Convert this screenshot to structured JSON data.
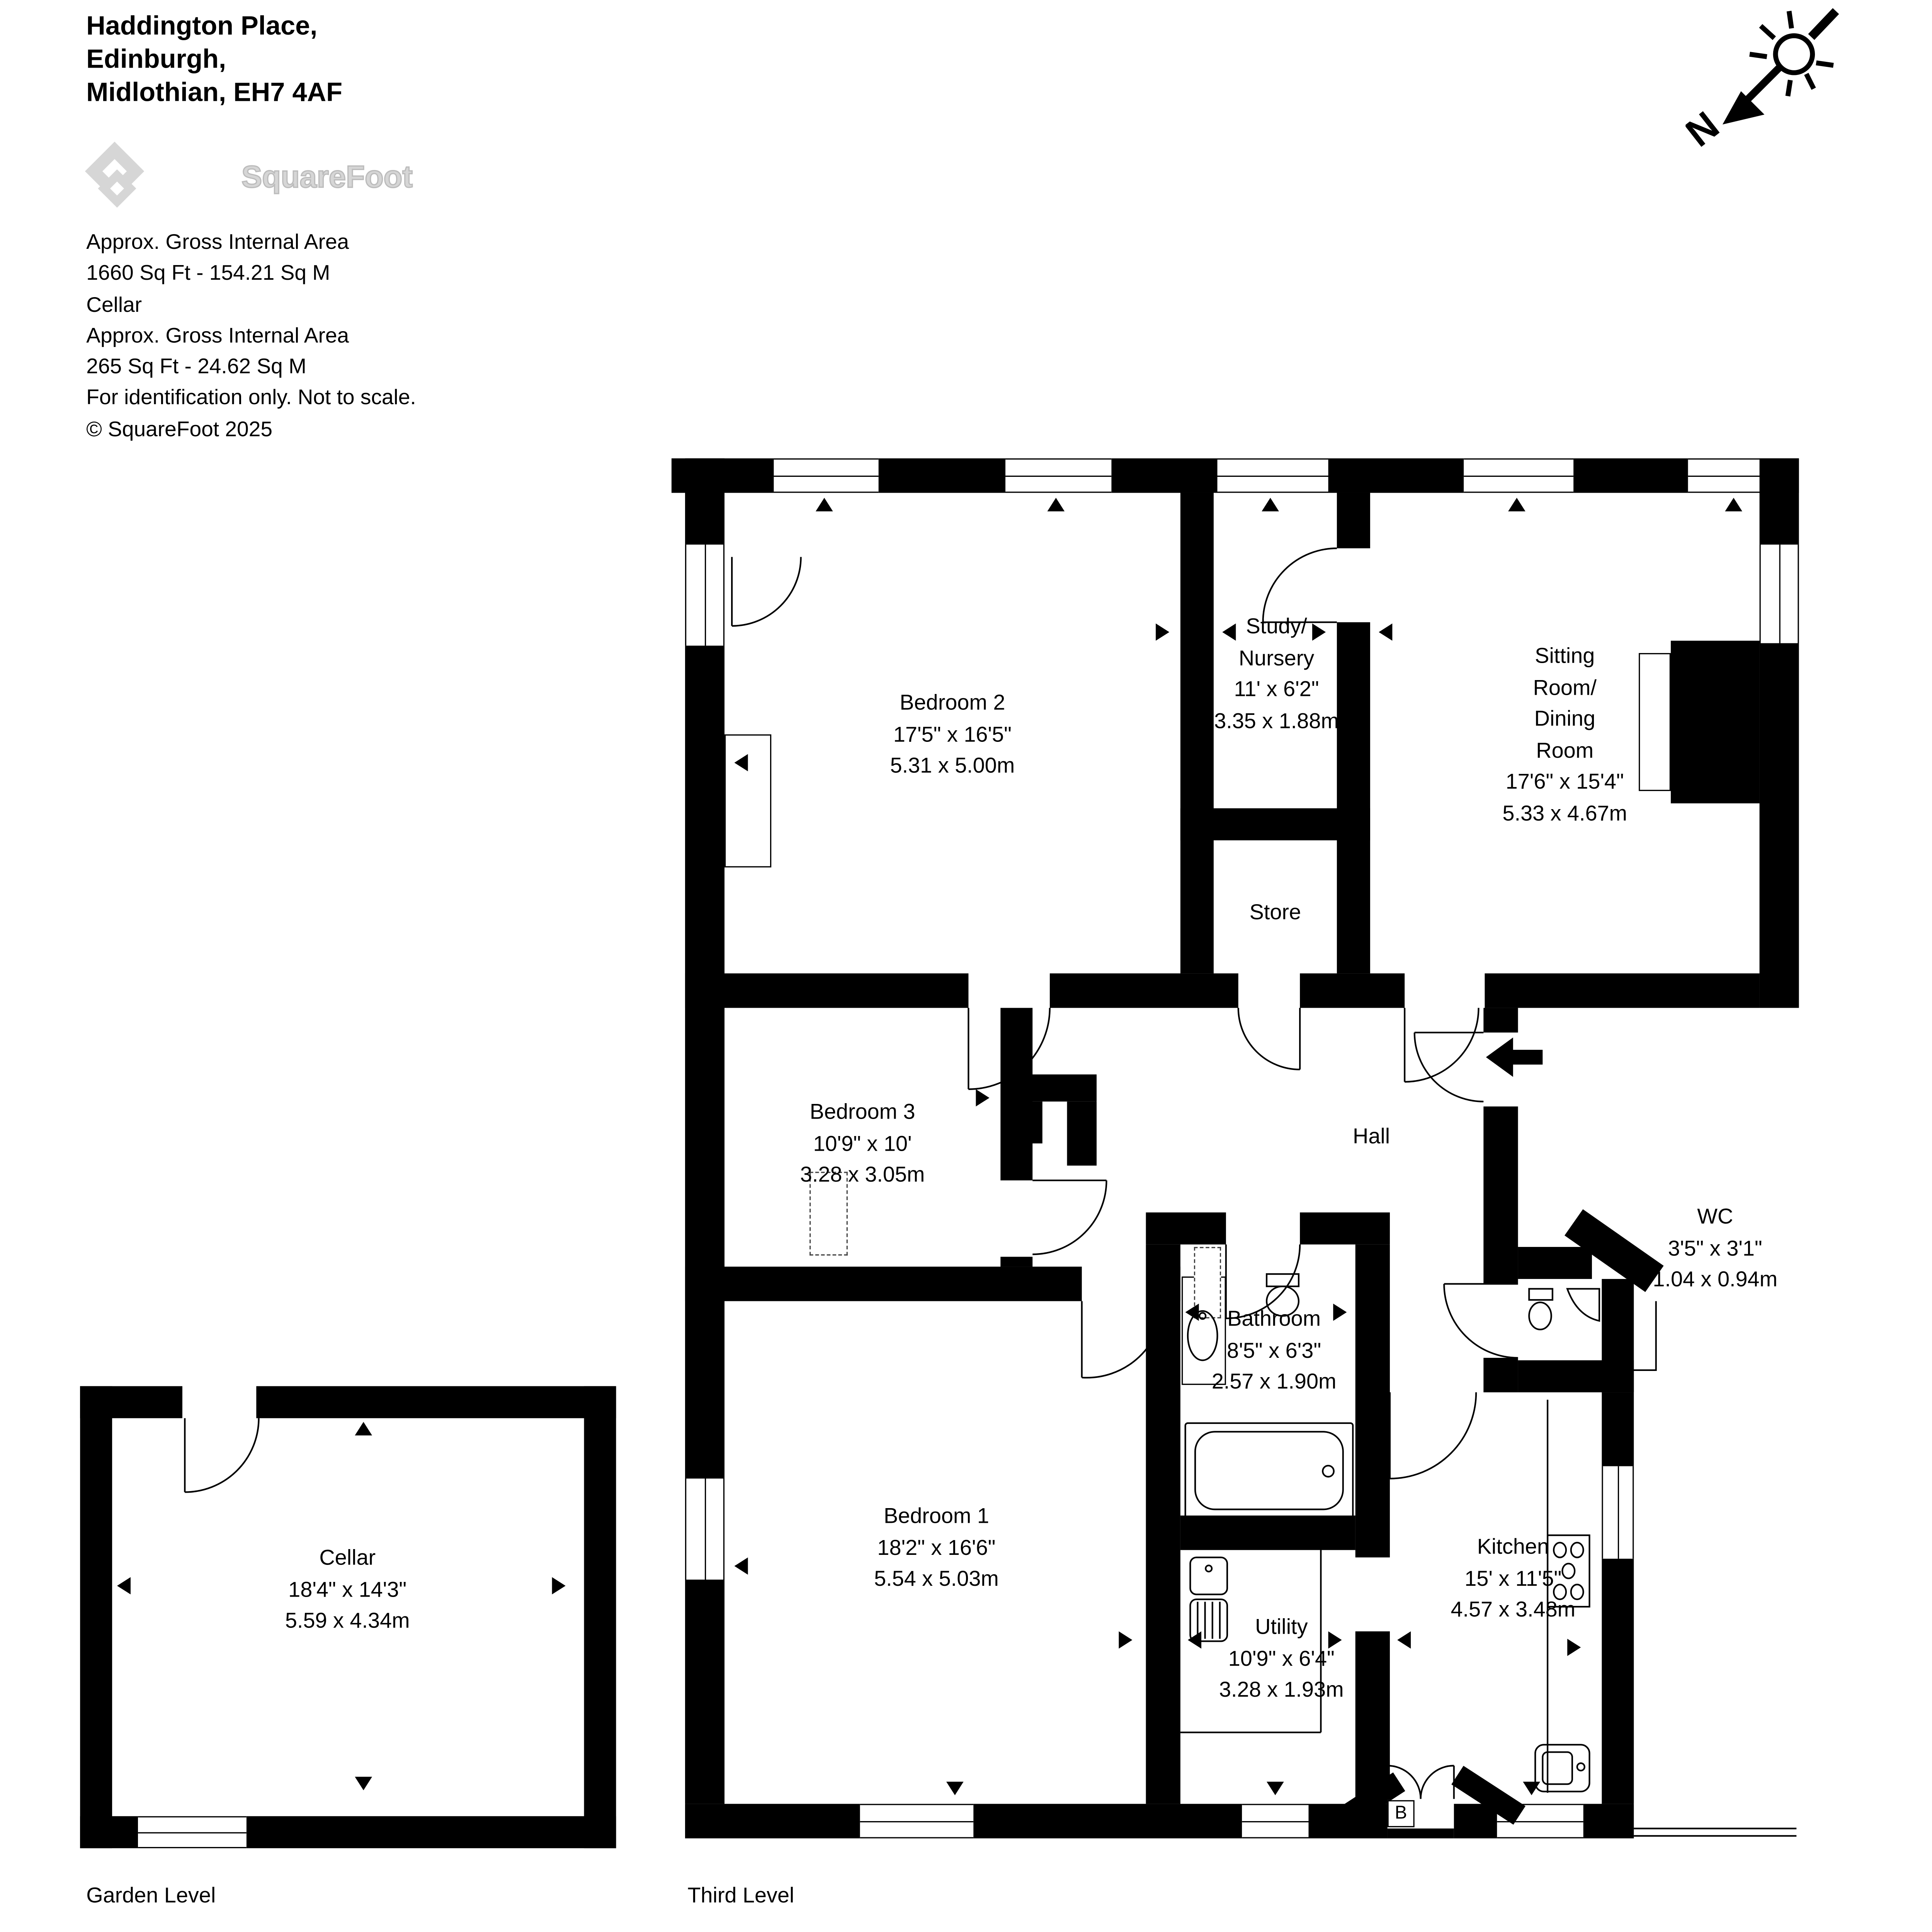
{
  "header": {
    "address_lines": [
      "Haddington Place,",
      "Edinburgh,",
      "Midlothian, EH7 4AF"
    ],
    "logo_text": "SquareFoot"
  },
  "area_summary": {
    "lines": [
      "Approx. Gross Internal Area",
      "1660 Sq Ft  -  154.21 Sq M",
      "Cellar",
      "Approx. Gross Internal Area",
      "265 Sq Ft  -  24.62 Sq M",
      "For identification only. Not to scale.",
      "© SquareFoot 2025"
    ]
  },
  "compass": {
    "label": "N",
    "icon": "sun-north-arrow-icon"
  },
  "floors": {
    "third": {
      "name": "Third Level"
    },
    "garden": {
      "name": "Garden Level"
    }
  },
  "rooms": {
    "bedroom2": {
      "name": "Bedroom 2",
      "imperial": "17'5\" x 16'5\"",
      "metric": "5.31 x 5.00m"
    },
    "study": {
      "name1": "Study/",
      "name2": "Nursery",
      "imperial": "11' x 6'2\"",
      "metric": "3.35 x 1.88m"
    },
    "sitting": {
      "name1": "Sitting",
      "name2": "Room/",
      "name3": "Dining",
      "name4": "Room",
      "imperial": "17'6\" x 15'4\"",
      "metric": "5.33 x 4.67m"
    },
    "store": {
      "name": "Store"
    },
    "bedroom3": {
      "name": "Bedroom 3",
      "imperial": "10'9\" x 10'",
      "metric": "3.28 x 3.05m"
    },
    "hall": {
      "name": "Hall"
    },
    "wc": {
      "name": "WC",
      "imperial": "3'5\" x 3'1\"",
      "metric": "1.04 x 0.94m"
    },
    "bathroom": {
      "name": "Bathroom",
      "imperial": "8'5\" x 6'3\"",
      "metric": "2.57 x 1.90m"
    },
    "bedroom1": {
      "name": "Bedroom 1",
      "imperial": "18'2\" x 16'6\"",
      "metric": "5.54 x 5.03m"
    },
    "utility": {
      "name": "Utility",
      "imperial": "10'9\" x 6'4\"",
      "metric": "3.28 x 1.93m"
    },
    "kitchen": {
      "name": "Kitchen",
      "imperial": "15' x 11'5\"",
      "metric": "4.57 x 3.48m"
    },
    "cellar": {
      "name": "Cellar",
      "imperial": "18'4\" x 14'3\"",
      "metric": "5.59 x 4.34m"
    }
  },
  "annotations": {
    "boiler": "B"
  },
  "colors": {
    "wall": "#000000",
    "logo_gray": "#d6d6d6",
    "background": "#ffffff"
  }
}
